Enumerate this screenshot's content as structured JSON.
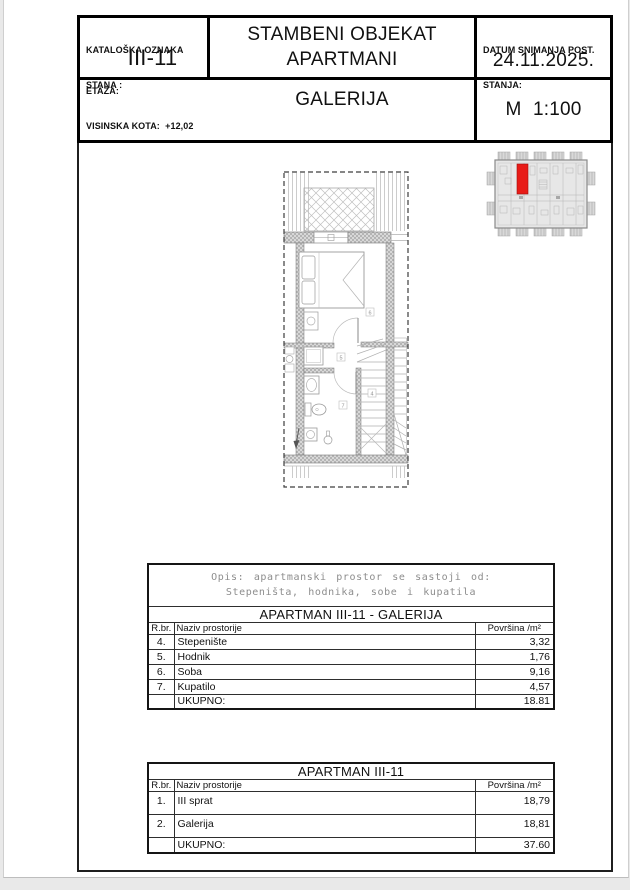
{
  "title_block": {
    "catalog": {
      "label_line1": "KATALOŠKA OZNAKA",
      "label_line2": "STANA :",
      "value": "III-11"
    },
    "project": {
      "line1": "STAMBENI OBJEKAT",
      "line2": "APARTMANI"
    },
    "survey_date": {
      "label_line1": "DATUM SNIMANJA POST.",
      "label_line2": "STANJA:",
      "value": "24.11.2025."
    },
    "floor": {
      "label": "ETAŽA:",
      "value": "GALERIJA"
    },
    "height_note": "VISINSKA KOTA:  +12,02",
    "scale": "M 1:100"
  },
  "plan": {
    "labels": {
      "stairs": "4",
      "hall": "5",
      "room": "6",
      "bath": "7"
    }
  },
  "key_plan": {
    "highlight_color": "#e81b17"
  },
  "tables": {
    "galerija": {
      "description_line1": "Opis: apartmanski prostor se sastoji od:",
      "description_line2": "Stepeništa, hodnika, sobe i kupatila",
      "title": "APARTMAN III-11 - GALERIJA",
      "columns": {
        "num": "R.br.",
        "name": "Naziv prostorije",
        "area": "Površina /m²"
      },
      "rows": [
        {
          "num": "4.",
          "name": "Stepenište",
          "area": "3,32"
        },
        {
          "num": "5.",
          "name": "Hodnik",
          "area": "1,76"
        },
        {
          "num": "6.",
          "name": "Soba",
          "area": "9,16"
        },
        {
          "num": "7.",
          "name": "Kupatilo",
          "area": "4,57"
        }
      ],
      "total_label": "UKUPNO:",
      "total_value": "18.81"
    },
    "apartman": {
      "title": "APARTMAN III-11",
      "columns": {
        "num": "R.br.",
        "name": "Naziv prostorije",
        "area": "Površina /m²"
      },
      "rows": [
        {
          "num": "1.",
          "name": "III sprat",
          "area": "18,79"
        },
        {
          "num": "2.",
          "name": "Galerija",
          "area": "18,81"
        }
      ],
      "total_label": "UKUPNO:",
      "total_value": "37.60"
    }
  }
}
